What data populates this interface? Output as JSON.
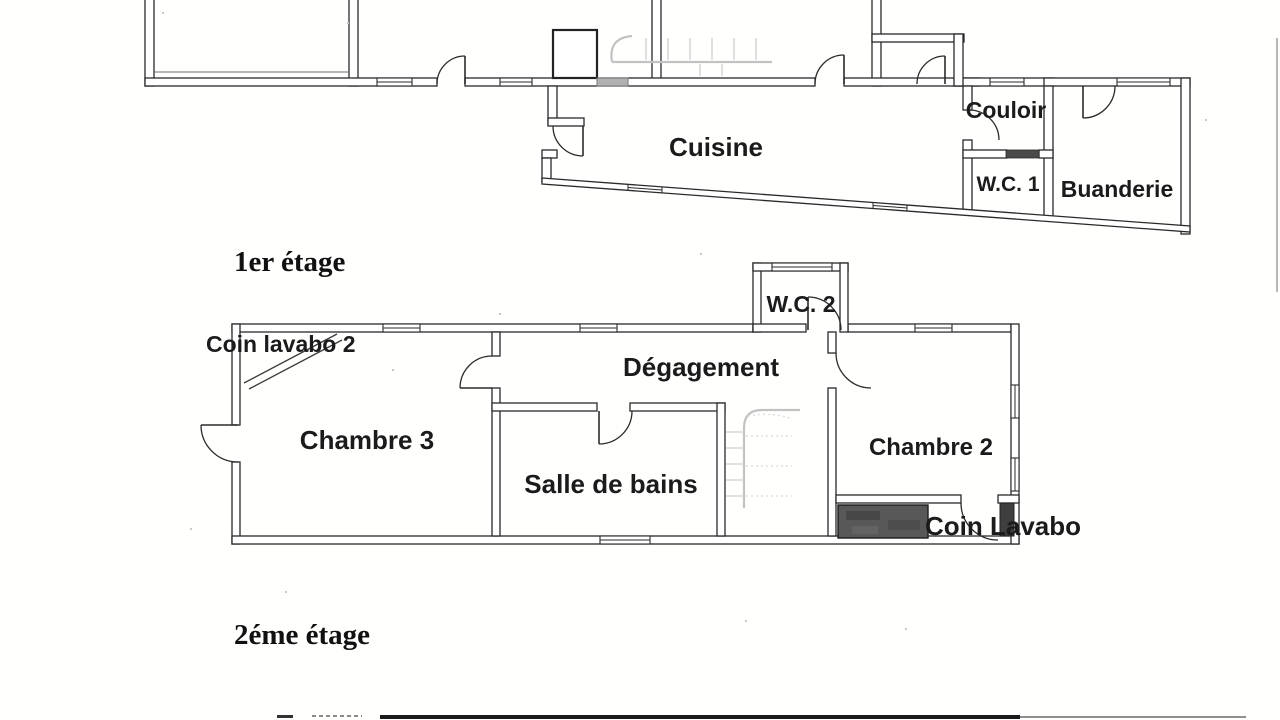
{
  "document": {
    "kind": "scanned floor plan",
    "language": "French"
  },
  "floors": {
    "ground": {
      "rooms": {
        "cuisine": "Cuisine",
        "couloir": "Couloir",
        "wc1": "W.C. 1",
        "buanderie": "Buanderie"
      }
    },
    "first": {
      "caption": "1er étage",
      "rooms": {
        "coin_lavabo2": "Coin lavabo 2",
        "wc2": "W.C. 2",
        "degagement": "Dégagement",
        "chambre3": "Chambre 3",
        "salle_de_bains": "Salle de bains",
        "chambre2": "Chambre 2",
        "coin_lavabo": "Coin Lavabo"
      }
    },
    "second": {
      "caption": "2éme étage"
    }
  },
  "colors": {
    "ink": "#2a2a2a",
    "paper": "#ffffff",
    "shading_block": "#585858",
    "door_sill": "#4a4a4a",
    "faint_stairs": "#c2c2c2"
  }
}
